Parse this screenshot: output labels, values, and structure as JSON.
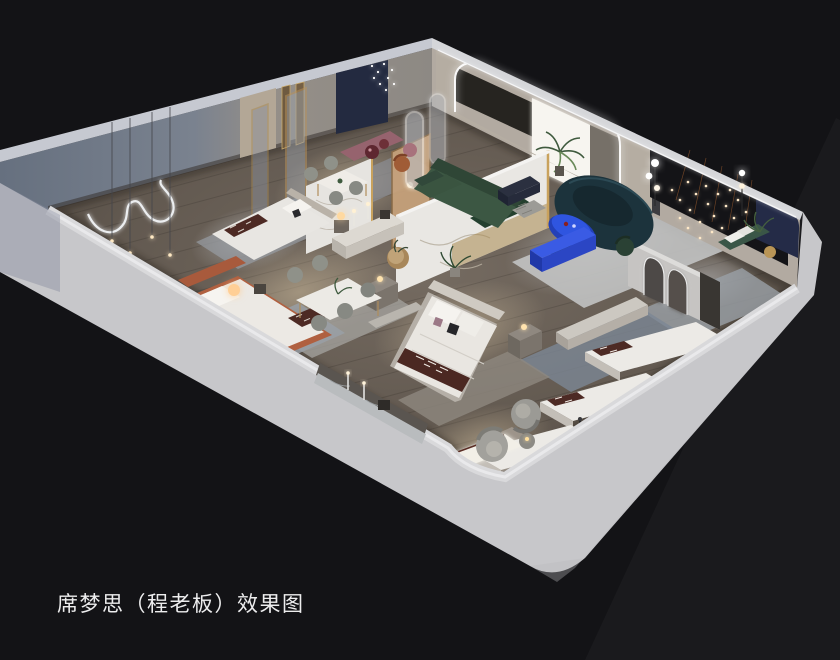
{
  "caption": {
    "text": "席梦思（程老板）效果图"
  },
  "scene": {
    "type": "3d-interior-render",
    "subject": "isometric cutaway rendering of a Simmons mattress showroom suite",
    "background_color": "#131316",
    "palette": {
      "outer_wall_light": "#c9c9cc",
      "wall_top_edge": "#dfe0e2",
      "far_wall_left_gray": "#78808e",
      "far_wall_right_beige": "#b2aaa1",
      "feature_wall_black": "#141417",
      "navy_panel": "#242b47",
      "floor_wood": "#5f574f",
      "marble_white": "#e9e7e3",
      "brass_gold": "#c9a25d",
      "sofa_green": "#3c5743",
      "sofa_teal_navy": "#1c333c",
      "accent_cobalt_blue": "#2f55e0",
      "bed_runner_maroon": "#4d2a24",
      "bed_terracotta": "#b06040",
      "bench_mauve": "#96636e",
      "rug_gray_blue": "#7c8795",
      "led_light": "#ffffff"
    },
    "elements": [
      "arch-feature-wall-with-led",
      "window-light",
      "green-l-sofa",
      "teal-curved-sofa",
      "cobalt-coffee-table",
      "cobalt-tv-bench",
      "string-lights-feature-wall",
      "navy-wall-panel",
      "marble-headboard-partition",
      "center-display-bed",
      "upper-left-display-bed",
      "terracotta-display-bed",
      "display-mattresses",
      "dining-set-upper",
      "dining-set-lower",
      "neon-squiggle-wall-art",
      "pendant-lights",
      "pill-led-mirrors",
      "arched-mirrors",
      "swivel-chairs",
      "lit-daybed",
      "marble-console-recess",
      "floor-lamp-spheres",
      "palm-plant"
    ]
  }
}
